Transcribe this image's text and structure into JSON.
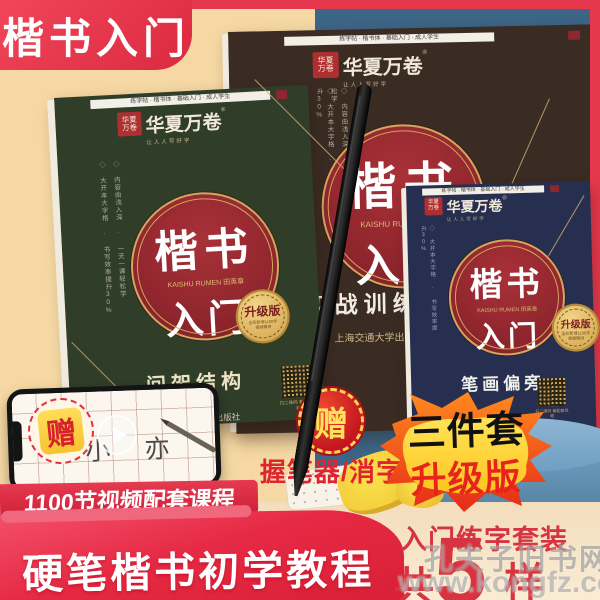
{
  "corner_banner": {
    "text": "楷书入门"
  },
  "watermark": {
    "line1": "孔夫子旧书网",
    "line2": "www.kongfz.com"
  },
  "brand": {
    "name": "华夏万卷",
    "reg": "®",
    "slogan": "让人人写好字",
    "seal_top": "华夏",
    "seal_bottom": "万卷"
  },
  "books": {
    "green": {
      "top_strip": "练字帖 · 楷书体 · 基础入门 · 成人学生",
      "side_note1": "◇ 大开本大字格 · 书写效率提升30%",
      "side_note2": "◇ 内容由浅入深 · 一天一课轻松学",
      "title_main": "楷书",
      "title_latin": "KAISHU RUMEN 田英章",
      "title_sub": "入门",
      "badge": "升级版",
      "badge_note1": "全彩新增1100字",
      "badge_note2": "视频精讲",
      "subtitle": "间架结构",
      "qr_caption": "扫二维码 看配套视频",
      "publisher": "上海交通大学出版社"
    },
    "brown": {
      "top_strip": "练字帖 · 楷书体 · 基础入门 · 成人学生",
      "side_note1": "◇ 大开本大字格 · 书写效率提升30%",
      "side_note2": "◇ 内容由浅入深 · 一天一课轻松学",
      "title_main": "楷书",
      "title_latin": "KAISHU RUMEN 田英章",
      "title_sub": "入门",
      "badge": "升级版",
      "badge_note1": "全彩新增1100字",
      "badge_note2": "视频精讲",
      "subtitle": "实战训练",
      "publisher": "上海交通大学出版社"
    },
    "blue": {
      "top_strip": "练字帖 · 楷书体 · 基础入门 · 成人学生",
      "side_note1": "◇ 大开本大字格 · 书写效率提升30%",
      "title_main": "楷书",
      "title_latin": "KAISHU RUMEN 田英章",
      "title_sub": "入门",
      "badge": "升级版",
      "badge_note1": "全彩新增1100字",
      "badge_note2": "视频精讲",
      "subtitle": "笔画偏旁",
      "qr_caption": "扫二维码 看配套视频"
    }
  },
  "phone": {
    "badge": "赠",
    "practice_chars": "小 亦"
  },
  "gift": {
    "badge": "赠",
    "items": "握笔器/消字笔"
  },
  "ribbon": {
    "text": "1100节视频配套课程"
  },
  "bottom_banner": {
    "text": "硬笔楷书初学教程"
  },
  "promo": {
    "flame_top": "三件套",
    "flame_bottom": "升级版",
    "set_label": "入门练字套装",
    "count_prefix": "共",
    "count_number": "5",
    "count_suffix": "样"
  },
  "colors": {
    "frame_red": "#E5384C",
    "peach": "#F5D8A3",
    "slate_blue": "#3D6586",
    "book_green": "#2F3D29",
    "book_brown": "#3A2B23",
    "book_navy": "#272F50",
    "medallion_red": "#A93138",
    "gold": "#CFA75E",
    "cream": "#F6E3C4",
    "promo_yellow": "#FFD94F"
  }
}
